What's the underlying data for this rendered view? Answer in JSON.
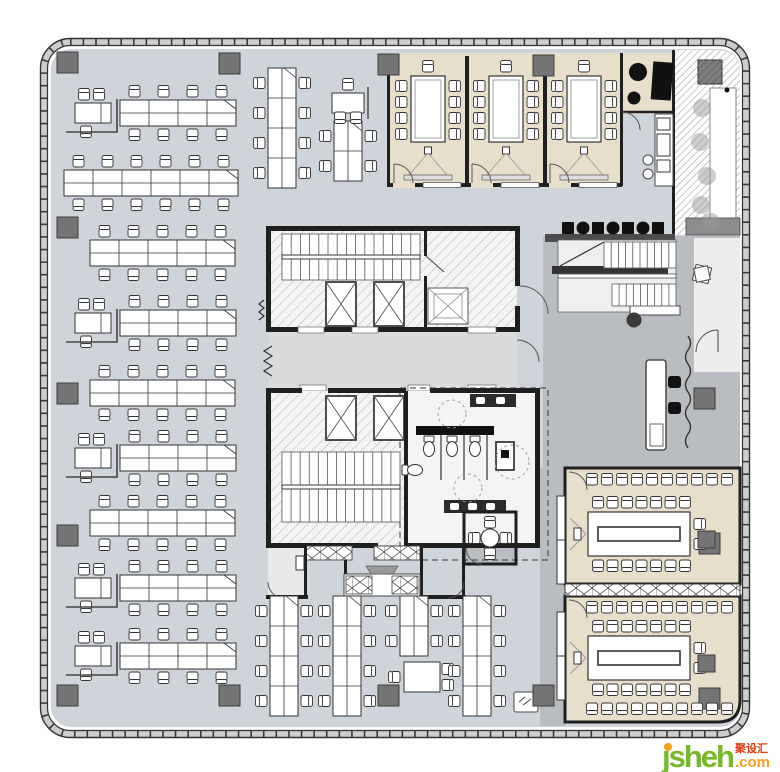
{
  "watermark": {
    "brand": "jsheh",
    "cjk": "聚设汇",
    "tld": ".com"
  },
  "colors": {
    "office": "#cfd4db",
    "lobby": "#b9bcc0",
    "corridor": "#dadbdd",
    "beige": "#e7dfca",
    "wall": "#1f1f1f",
    "column": "#757575",
    "hatch": "#b3b3b3",
    "black_furniture": "#111111",
    "wm_green": "#76b82a",
    "wm_orange": "#f7a11a",
    "wm_red": "#e8380d"
  },
  "plan": {
    "benches_h": [
      {
        "x": 120,
        "y": 100,
        "m": 4,
        "mgr": 1
      },
      {
        "x": 64,
        "y": 170,
        "m": 6
      },
      {
        "x": 90,
        "y": 240,
        "m": 5
      },
      {
        "x": 120,
        "y": 310,
        "m": 4,
        "mgr": 1
      },
      {
        "x": 90,
        "y": 380,
        "m": 5
      },
      {
        "x": 120,
        "y": 445,
        "m": 4,
        "mgr": 1
      },
      {
        "x": 90,
        "y": 510,
        "m": 5
      },
      {
        "x": 120,
        "y": 575,
        "m": 4,
        "mgr": 1
      },
      {
        "x": 120,
        "y": 643,
        "m": 4,
        "mgr": 1
      }
    ],
    "benches_v": [
      {
        "x": 268,
        "y": 68,
        "m": 4
      },
      {
        "x": 334,
        "y": 121,
        "m": 2,
        "mgrTop": 1
      },
      {
        "x": 270,
        "y": 596,
        "m": 4
      },
      {
        "x": 333,
        "y": 596,
        "m": 4
      },
      {
        "x": 400,
        "y": 596,
        "m": 2,
        "meet": 1
      },
      {
        "x": 463,
        "y": 596,
        "m": 4
      }
    ],
    "columns": [
      [
        57,
        52
      ],
      [
        219,
        53
      ],
      [
        378,
        54
      ],
      [
        533,
        55
      ],
      [
        57,
        217
      ],
      [
        57,
        383
      ],
      [
        57,
        525
      ],
      [
        57,
        685
      ],
      [
        219,
        685
      ],
      [
        378,
        685
      ],
      [
        533,
        685
      ],
      [
        699,
        533
      ],
      [
        699,
        688
      ],
      [
        694,
        388
      ]
    ],
    "elevators": [
      [
        326,
        282
      ],
      [
        374,
        282
      ],
      [
        326,
        396
      ],
      [
        374,
        396
      ]
    ],
    "service_lift": [
      428,
      288,
      40,
      36
    ],
    "stairs": [
      {
        "x": 282,
        "y": 234,
        "w": 138,
        "h": 46,
        "n": 14,
        "rail": 1
      },
      {
        "x": 282,
        "y": 452,
        "w": 118,
        "h": 70,
        "n": 12,
        "rail": 1
      },
      {
        "x": 604,
        "y": 242,
        "w": 72,
        "h": 26,
        "n": 9
      },
      {
        "x": 612,
        "y": 284,
        "w": 64,
        "h": 22,
        "n": 8
      }
    ],
    "meeting_rooms_top": {
      "lefts": [
        389,
        467,
        545
      ],
      "width": 78,
      "y": 56,
      "h": 130
    },
    "training_rooms": [
      {
        "x": 565,
        "y": 468,
        "w": 175,
        "h": 116,
        "bottomRow": 0
      },
      {
        "x": 565,
        "y": 596,
        "w": 175,
        "h": 126,
        "bottomRow": 1
      }
    ],
    "banquette": {
      "x0": 562,
      "y": 222,
      "n": 7,
      "step": 15
    },
    "toilets": [
      [
        429,
        446,
        0
      ],
      [
        452,
        446,
        0
      ],
      [
        475,
        446,
        0
      ],
      [
        412,
        470,
        270
      ]
    ],
    "round_table": {
      "cx": 490,
      "cy": 538,
      "r": 9
    },
    "blobs": [
      [
        702,
        108
      ],
      [
        700,
        142
      ],
      [
        707,
        176
      ],
      [
        701,
        205
      ],
      [
        711,
        222
      ]
    ]
  }
}
